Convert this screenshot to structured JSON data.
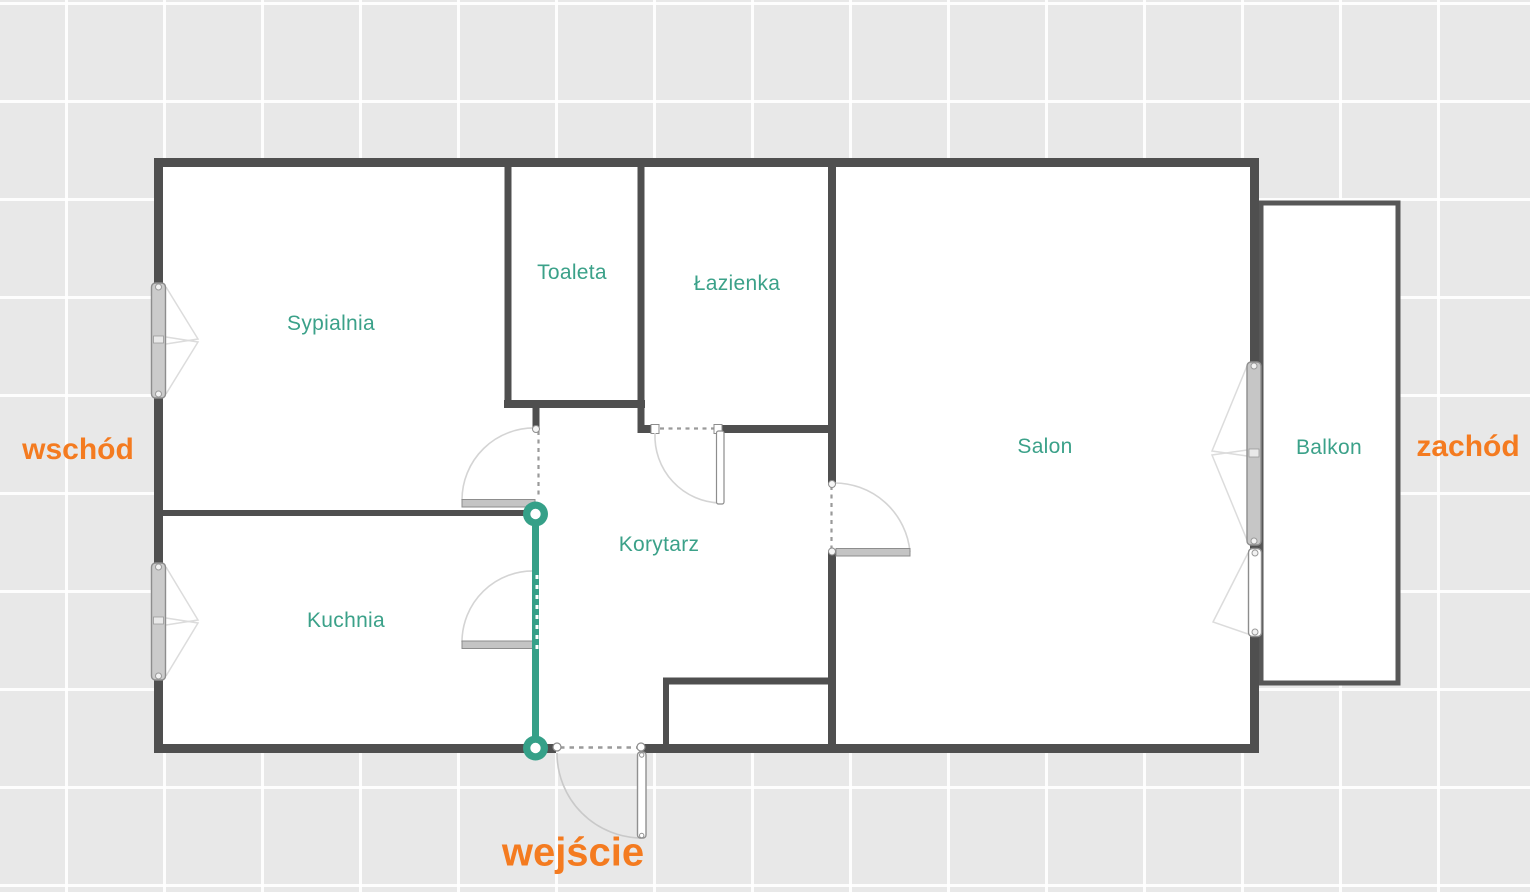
{
  "plan": {
    "title": "apartment-floor-plan",
    "rooms": {
      "sypialnia": "Sypialnia",
      "toaleta": "Toaleta",
      "lazienka": "Łazienka",
      "salon": "Salon",
      "balkon": "Balkon",
      "kuchnia": "Kuchnia",
      "korytarz": "Korytarz"
    },
    "directions": {
      "east": "wschód",
      "west": "zachód"
    },
    "entrance": {
      "label": "wejście"
    },
    "colors": {
      "room_label": "#3ba189",
      "accent_orange": "#f47b20",
      "wall": "#4f4f4f",
      "balcony_wall": "#575757",
      "selected_wall_teal": "#35a088",
      "door_arc": "#d4d4d4",
      "opening_dash": "#9a9a9a",
      "background": "#e8e8e8",
      "interior": "#ffffff"
    }
  }
}
